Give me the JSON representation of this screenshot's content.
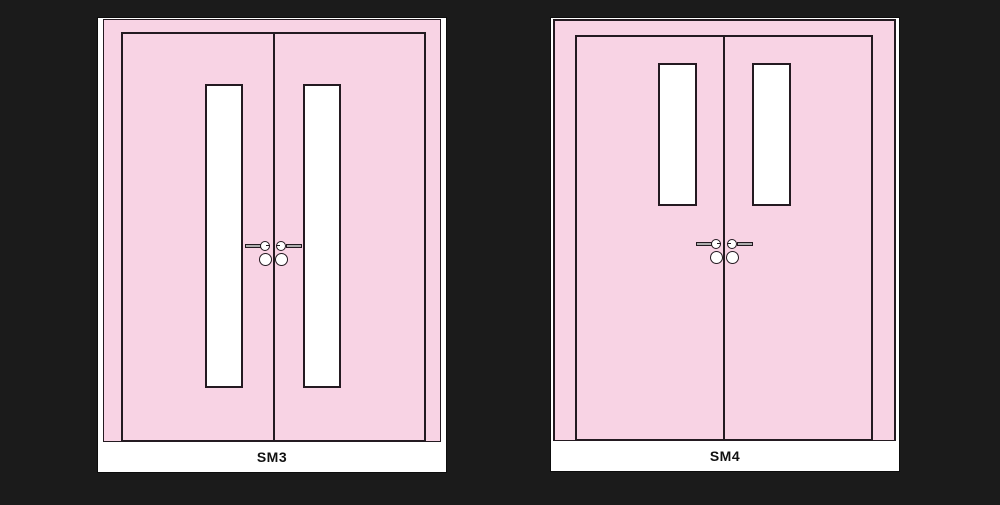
{
  "background_color": "#1b1b1b",
  "colors": {
    "door_pink": "#f8d3e4",
    "outline_black": "#241a21",
    "card_white": "#ffffff",
    "lever_gray": "#adadad"
  },
  "doors": [
    {
      "label": "SM3",
      "leaf_count": 2,
      "vision_panels": "two full-height narrow glazed panels beside the meeting stile",
      "hardware": "lever handles with roses and knobs at meeting stile"
    },
    {
      "label": "SM4",
      "leaf_count": 2,
      "vision_panels": "two short narrow glazed panels at the top beside the meeting stile",
      "hardware": "lever handles with roses and knobs at meeting stile"
    }
  ]
}
